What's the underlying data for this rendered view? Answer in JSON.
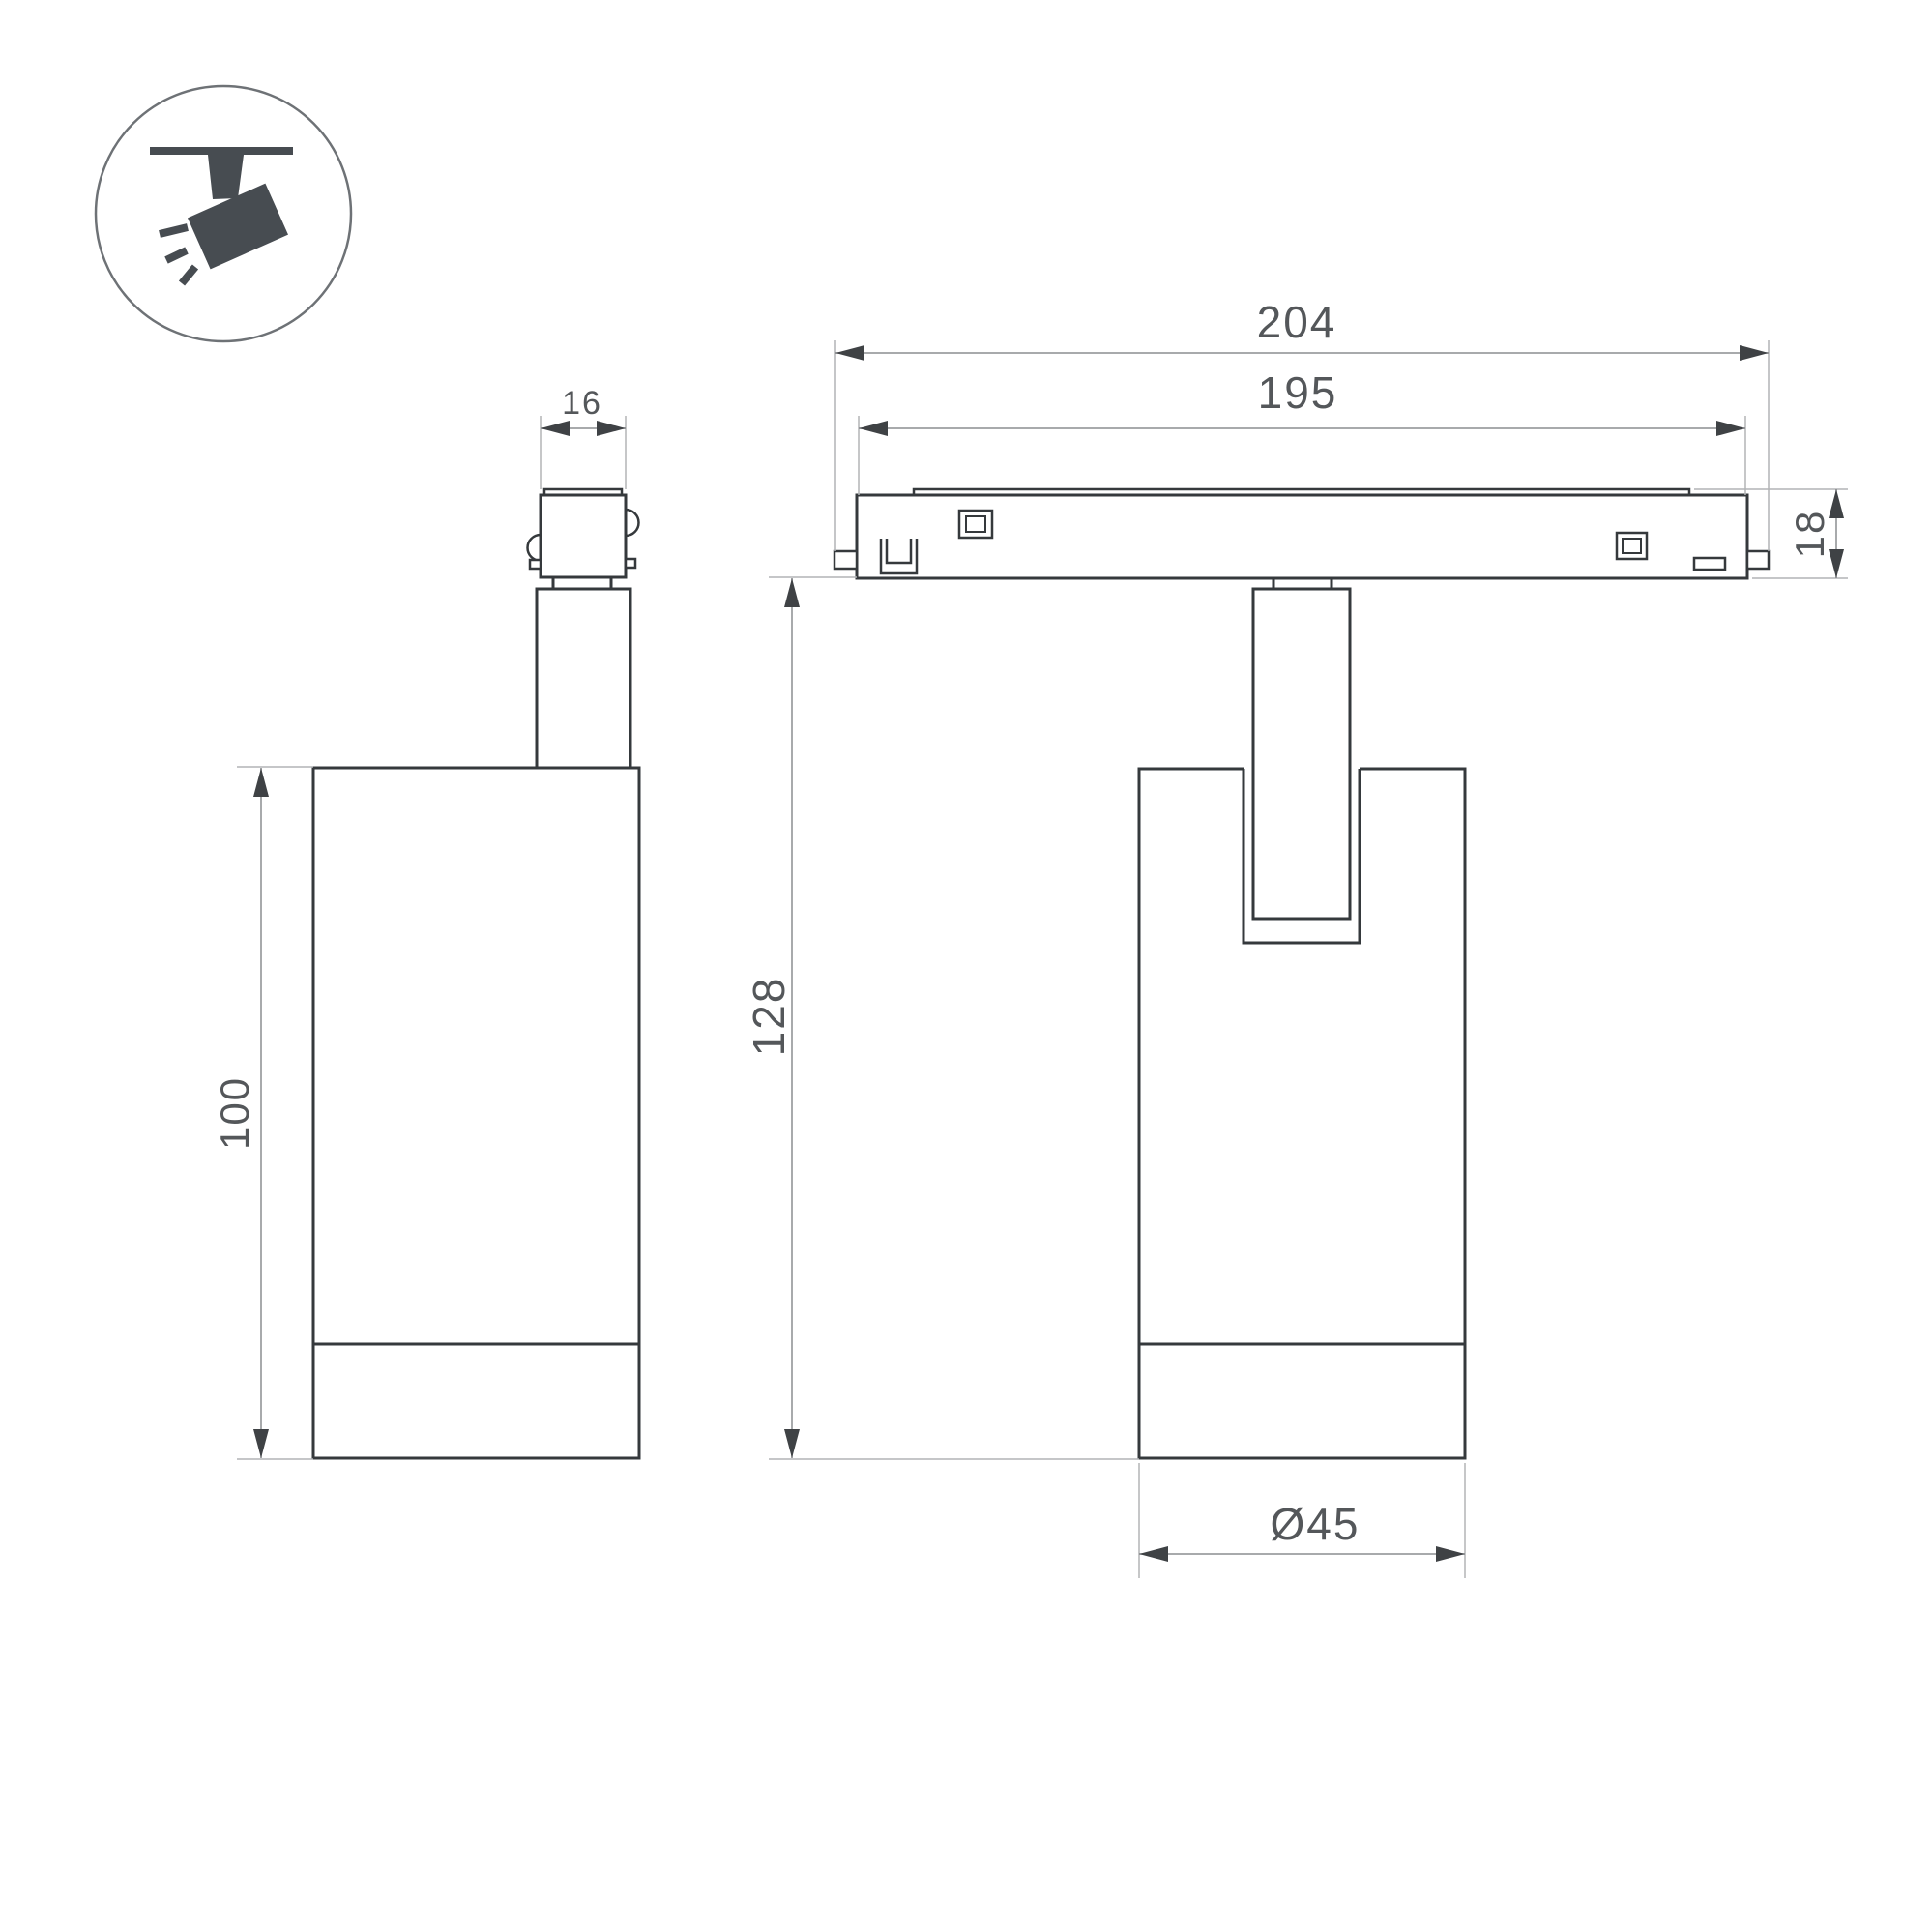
{
  "icon": {
    "name": "ceiling-track-spotlight-pictogram"
  },
  "views": {
    "side": "side-view-of-spotlight",
    "front": "front-view-of-spotlight-on-track"
  },
  "dimensions": {
    "adapter_width": {
      "label": "16"
    },
    "overall_length": {
      "label": "204"
    },
    "body_length": {
      "label": "195"
    },
    "track_height": {
      "label": "18"
    },
    "overall_height": {
      "label": "128"
    },
    "body_height": {
      "label": "100"
    },
    "diameter": {
      "label": "Ø45"
    }
  },
  "colors": {
    "outline": "#35393c",
    "dimension_line": "#8b8e91",
    "extension_line": "#b2b4b6",
    "arrow": "#3f4245",
    "text": "#54575a",
    "icon_fill": "#474c51",
    "background": "#ffffff"
  }
}
